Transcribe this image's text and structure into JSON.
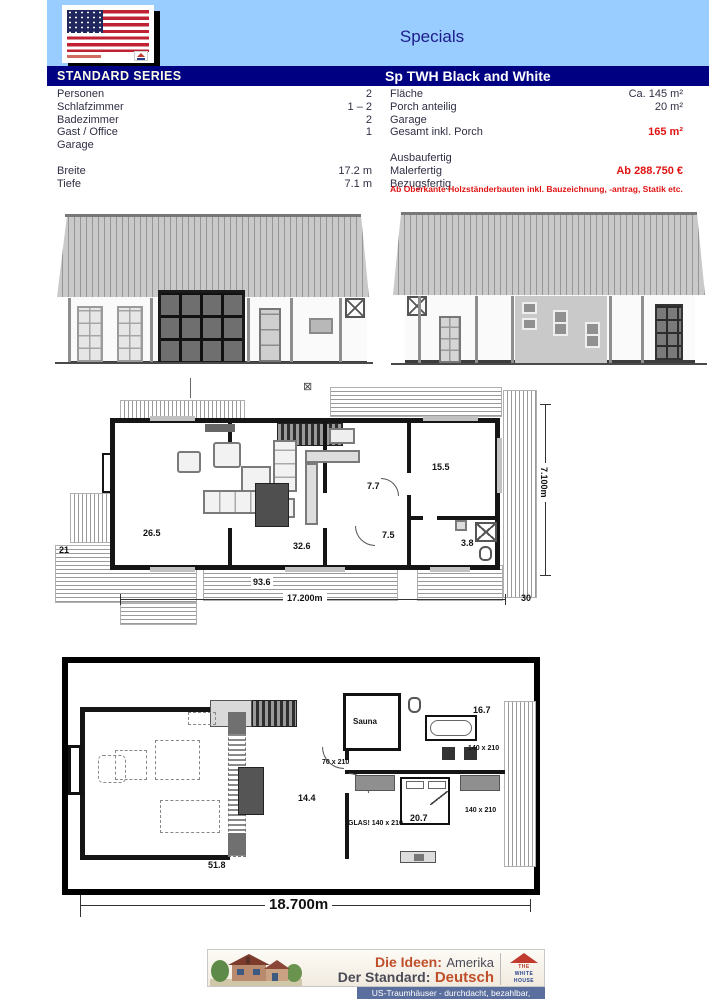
{
  "page": {
    "title": "Specials"
  },
  "header": {
    "series_label": "STANDARD SERIES",
    "model_name": "Sp TWH Black and White"
  },
  "specs": {
    "left": {
      "rows": [
        {
          "label": "Personen",
          "value": "2"
        },
        {
          "label": "Schlafzimmer",
          "value": "1 – 2"
        },
        {
          "label": "Badezimmer",
          "value": "2"
        },
        {
          "label": "Gast / Office",
          "value": "1"
        },
        {
          "label": "Garage",
          "value": ""
        },
        {
          "label": "Breite",
          "value": "17.2 m"
        },
        {
          "label": "Tiefe",
          "value": "7.1 m"
        }
      ]
    },
    "right": {
      "rows": [
        {
          "label": "Fläche",
          "value": "Ca. 145 m²"
        },
        {
          "label": "Porch anteilig",
          "value": "20 m²"
        },
        {
          "label": "Garage",
          "value": ""
        },
        {
          "label": "Gesamt inkl. Porch",
          "value": "165 m²"
        },
        {
          "label": "Ausbaufertig",
          "value": ""
        },
        {
          "label": "Malerfertig",
          "value": "Ab 288.750 €"
        },
        {
          "label": "Bezugsfertig",
          "value": ""
        }
      ],
      "disclaimer": "Ab Oberkante Holzständerbauten inkl. Bauzeichnung, -antrag, Statik etc."
    }
  },
  "plan1": {
    "north_mark": "⊠",
    "rooms": {
      "living": "26.5",
      "dining": "32.6",
      "kitchen": "7.7",
      "hall": "7.5",
      "bedroom": "15.5",
      "bath": "3.8"
    },
    "area_label": "93.6",
    "deck_left": "21",
    "deck_right": "30",
    "dim_width": "17.200m",
    "dim_depth": "7.100m"
  },
  "plan2": {
    "rooms": {
      "living": "51.8",
      "dining": "14.4",
      "sauna": "Sauna",
      "bath": "16.7",
      "bedroom": "20.7"
    },
    "win_door": "70 x 210",
    "win_bath": "140 x 210",
    "win_bed": "140 x 210",
    "win_glas": "GLAS! 140 x 210",
    "dim_width": "18.700m"
  },
  "footer": {
    "brand": {
      "line1_accent": "Die Ideen:",
      "line1_rest": "Amerika",
      "line2_rest": "Der Standard:",
      "line2_accent": "Deutsch"
    },
    "tagline": "US-Traumhäuser - durchdacht, bezahlbar, variabel",
    "logo": {
      "the": "THE",
      "white": "WHITE",
      "house": "HOUSE"
    }
  },
  "colors": {
    "header_blue": "#99CCFF",
    "navy": "#000082",
    "price_red": "#E01313",
    "series_text": "#FBFBE6",
    "footer_accent": "#BF4F2A",
    "footer_dark": "#4B4B57",
    "footer_strip": "#5B6F9E"
  }
}
